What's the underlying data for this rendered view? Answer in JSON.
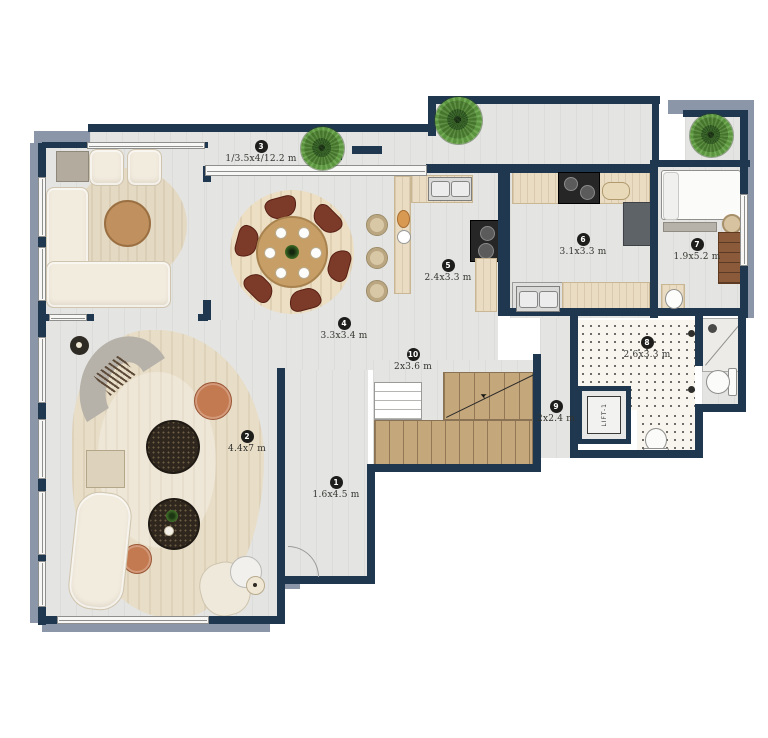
{
  "title": "apartment-floor-plan",
  "rooms": [
    {
      "num": "1",
      "dim": "1.6x4.5 m"
    },
    {
      "num": "2",
      "dim": "4.4x7 m"
    },
    {
      "num": "3",
      "dim": "1/3.5x4/12.2 m"
    },
    {
      "num": "4",
      "dim": "3.3x3.4 m"
    },
    {
      "num": "5",
      "dim": "2.4x3.3 m"
    },
    {
      "num": "6",
      "dim": "3.1x3.3 m"
    },
    {
      "num": "7",
      "dim": "1.9x5.2 m"
    },
    {
      "num": "8",
      "dim": "2.6x3.3 m"
    },
    {
      "num": "9",
      "dim": "2x2.4 m"
    },
    {
      "num": "10",
      "dim": "2x3.6 m"
    }
  ],
  "lift": {
    "label": "LIFT-1"
  },
  "colors": {
    "wall": "#20384f",
    "shadow": "#8c96a9",
    "floor": "#e4e4e2",
    "rug_beige": "#e9dcc2",
    "wood": "#c5a77c",
    "terracotta": "#c47a51",
    "plant_green": "#4c8030",
    "sofa_cream": "#f2ecdf"
  }
}
